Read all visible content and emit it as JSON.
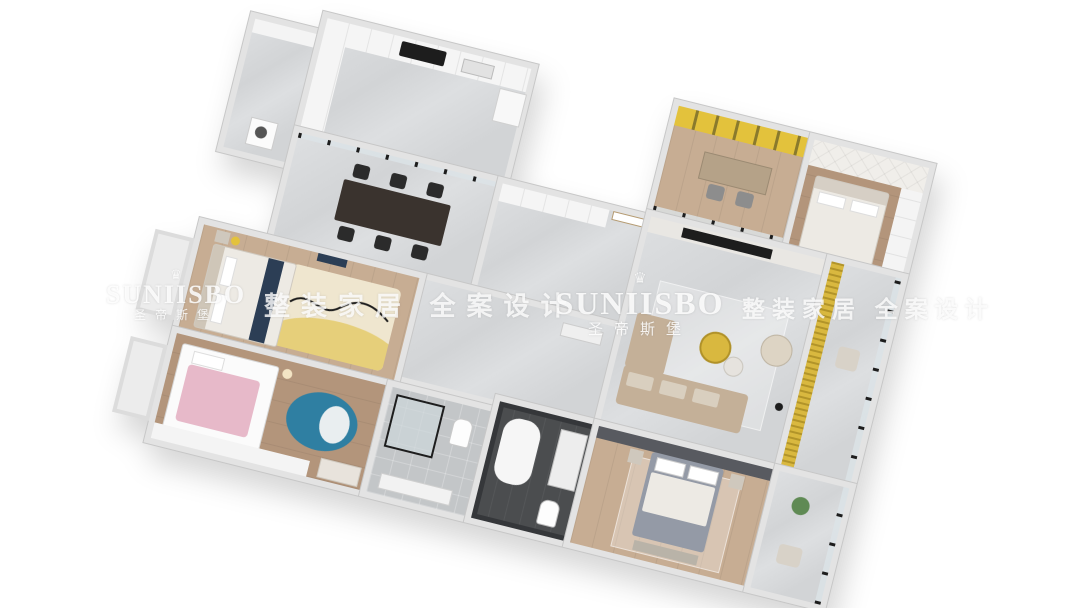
{
  "watermark": {
    "crown_glyph": "♛",
    "brand_latin": "SUNIISBO",
    "brand_cn": "圣帝斯堡",
    "tagline": "整装家居 全案设计"
  },
  "colors": {
    "wall": "#e3e3e3",
    "wall_edge": "#c7c7c7",
    "marble": "#d2d4d6",
    "marble_light": "#dddfe1",
    "wood": "#c7ad93",
    "wood_dark": "#b3957b",
    "tile": "#c3c6c8",
    "gold": "#d9b83f",
    "yellow_accent": "#e3c23c",
    "pink": "#e7b9c9",
    "teal_rug": "#2f7fa2",
    "sofa": "#c4b098",
    "cushion": "#d9cfbf",
    "bed_gray": "#949aa6",
    "duvet": "#edeae4",
    "dark_wall": "#4b4d4f",
    "headboard_dark": "#585a60",
    "black": "#1d1d1d",
    "cream_rug": "#efe6cf",
    "navy": "#2c3e55",
    "plant": "#5f8a54"
  }
}
